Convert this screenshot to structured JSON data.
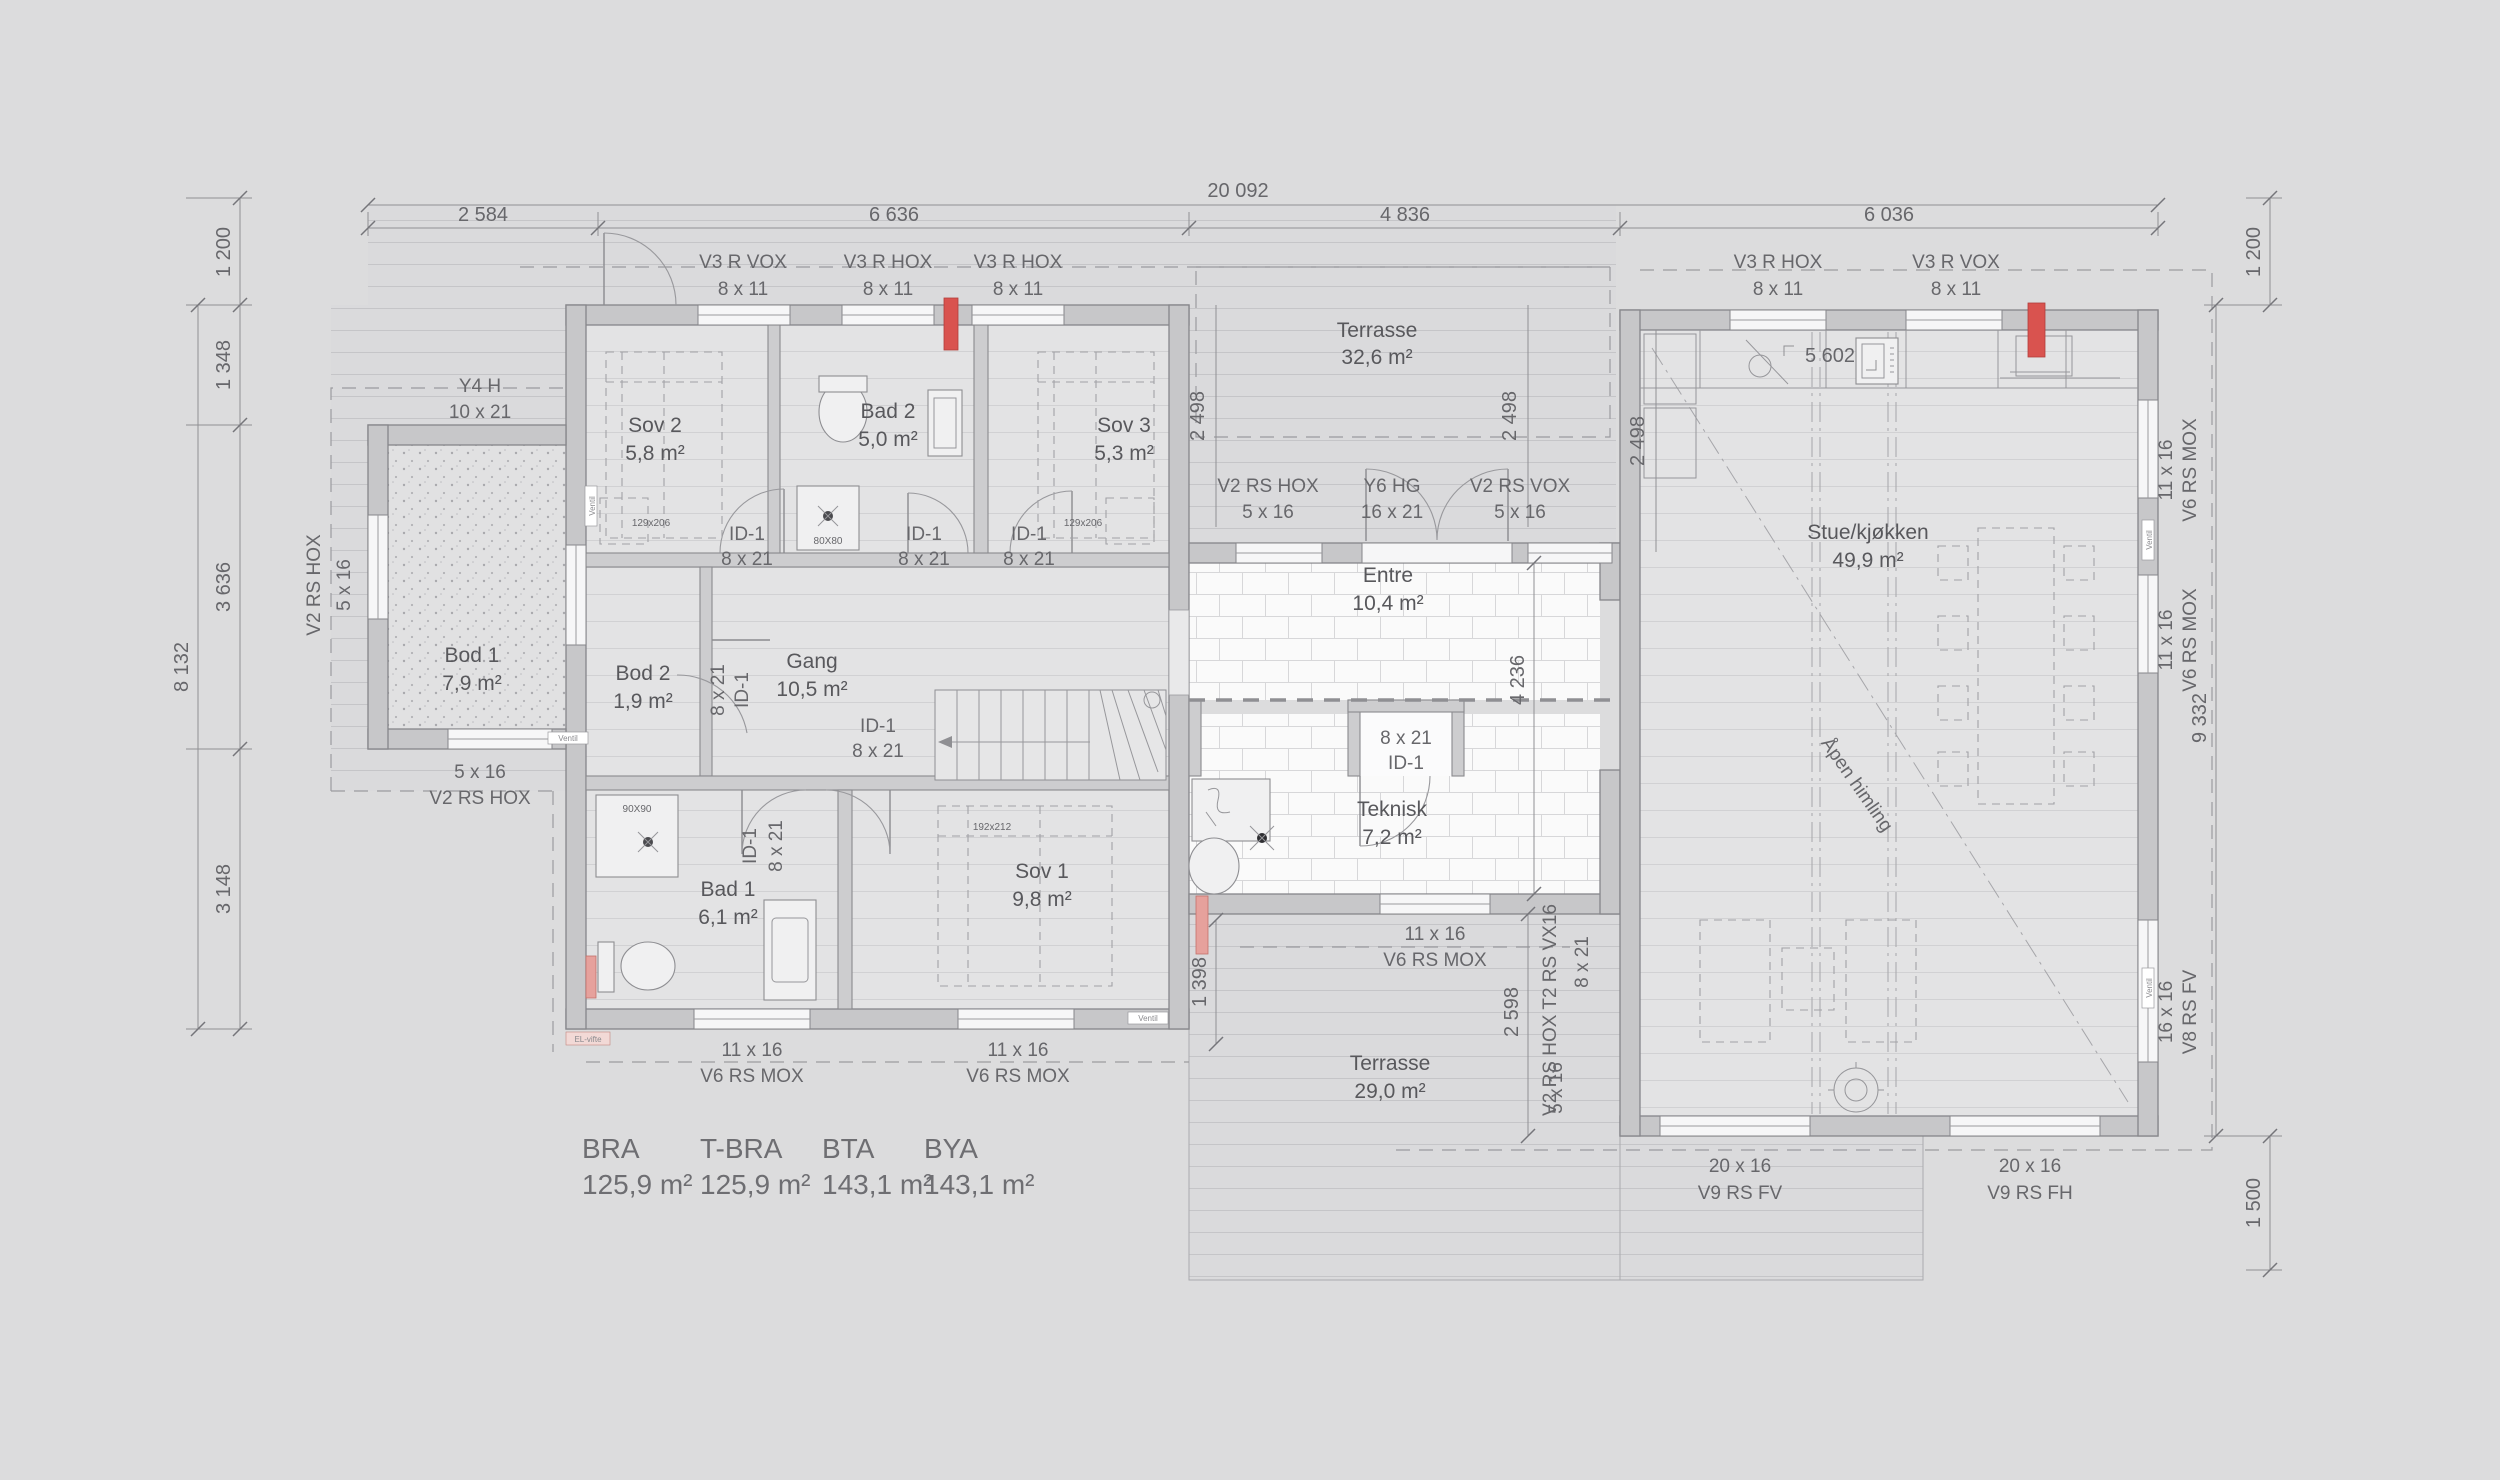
{
  "dims": {
    "overall": "20 092",
    "seg1": "2 584",
    "seg2": "6 636",
    "seg3": "4 836",
    "seg4": "6 036",
    "l1200": "1 200",
    "l1348": "1 348",
    "l3636": "3 636",
    "l3148": "3 148",
    "l8132": "8 132",
    "r1200": "1 200",
    "r9332": "9 332",
    "r1500": "1 500",
    "d2498a": "2 498",
    "d2498b": "2 498",
    "d2498c": "2 498",
    "d4236": "4 236",
    "d5602": "5 602",
    "d1398": "1 398",
    "d2598": "2 598"
  },
  "rooms": {
    "sov2": {
      "name": "Sov 2",
      "area": "5,8 m²"
    },
    "bad2": {
      "name": "Bad 2",
      "area": "5,0 m²"
    },
    "sov3": {
      "name": "Sov 3",
      "area": "5,3 m²"
    },
    "bod1": {
      "name": "Bod 1",
      "area": "7,9 m²"
    },
    "bod2": {
      "name": "Bod 2",
      "area": "1,9 m²"
    },
    "gang": {
      "name": "Gang",
      "area": "10,5 m²"
    },
    "bad1": {
      "name": "Bad 1",
      "area": "6,1 m²"
    },
    "sov1": {
      "name": "Sov 1",
      "area": "9,8 m²"
    },
    "entre": {
      "name": "Entre",
      "area": "10,4 m²"
    },
    "teknisk": {
      "name": "Teknisk",
      "area": "7,2 m²"
    },
    "stue": {
      "name": "Stue/kjøkken",
      "area": "49,9 m²"
    },
    "terr_top": {
      "name": "Terrasse",
      "area": "32,6 m²"
    },
    "terr_bot": {
      "name": "Terrasse",
      "area": "29,0 m²"
    }
  },
  "openings": {
    "t1": {
      "l1": "V3 R VOX",
      "l2": "8 x 11"
    },
    "t2": {
      "l1": "V3 R HOX",
      "l2": "8 x 11"
    },
    "t3": {
      "l1": "V3 R HOX",
      "l2": "8 x 11"
    },
    "rt1": {
      "l1": "V3 R HOX",
      "l2": "8 x 11"
    },
    "rt2": {
      "l1": "V3 R VOX",
      "l2": "8 x 11"
    },
    "y4h": {
      "l1": "Y4 H",
      "l2": "10 x 21"
    },
    "m1": {
      "l1": "V2 RS HOX",
      "l2": "5 x 16"
    },
    "m2": {
      "l1": "Y6 HG",
      "l2": "16 x 21"
    },
    "m3": {
      "l1": "V2 RS VOX",
      "l2": "5 x 16"
    },
    "ax1": {
      "l1": "V2 RS HOX",
      "l2": "5 x 16"
    },
    "ax2": {
      "l1": "5 x 16",
      "l2": "V2 RS HOX"
    },
    "bl1": {
      "l1": "11 x 16",
      "l2": "V6 RS MOX"
    },
    "bl2": {
      "l1": "11 x 16",
      "l2": "V6 RS MOX"
    },
    "bm": {
      "l1": "11 x 16",
      "l2": "V6 RS MOX"
    },
    "rr1": {
      "l1": "11 x 16",
      "l2": "V6 RS MOX"
    },
    "rr2": {
      "l1": "11 x 16",
      "l2": "V6 RS MOX"
    },
    "rr3": {
      "l1": "16 x 16",
      "l2": "V8 RS FV"
    },
    "bb1": {
      "l1": "20 x 16",
      "l2": "V9 RS FV"
    },
    "bb2": {
      "l1": "20 x 16",
      "l2": "V9 RS FH"
    },
    "tmix": {
      "l1": "V2 RS HOX T2 RS VX16",
      "l2": "8 x 21",
      "l3": "5 x 16"
    }
  },
  "doors": {
    "id_a": {
      "l1": "ID-1",
      "l2": "8 x 21"
    },
    "id_b": {
      "l1": "ID-1",
      "l2": "8 x 21"
    },
    "id_c": {
      "l1": "ID-1",
      "l2": "8 x 21"
    },
    "id_bod2": {
      "l1": "8 x 21",
      "l2": "ID-1"
    },
    "id_gang": {
      "l1": "ID-1",
      "l2": "8 x 21"
    },
    "id_bad1": {
      "l1": "ID-1",
      "l2": "8 x 21"
    },
    "id_closet": {
      "l1": "8 x 21",
      "l2": "ID-1"
    }
  },
  "fixtures": {
    "bed_s2": "129x206",
    "bed_s3": "129x206",
    "bed_s1": "192x212",
    "shower2": "80X80",
    "shower1": "90X90"
  },
  "areas": {
    "h1": "BRA",
    "h2": "T-BRA",
    "h3": "BTA",
    "h4": "BYA",
    "v1": "125,9 m²",
    "v2": "125,9 m²",
    "v3": "143,1 m²",
    "v4": "143,1 m²"
  },
  "misc": {
    "apen": "Åpen himling",
    "ventil": "Ventil",
    "elvifte": "EL-vifte"
  },
  "colors": {
    "accent_red": "#d9534f",
    "wall_gray": "#c7c7c9",
    "paper": "#dcdcdd"
  }
}
